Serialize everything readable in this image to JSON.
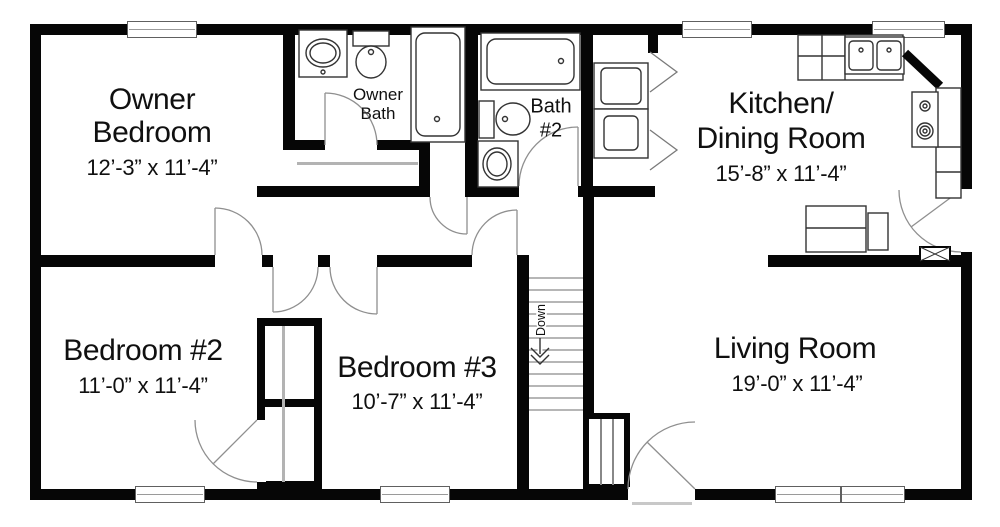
{
  "rooms": {
    "owner_bedroom": {
      "line1": "Owner",
      "line2": "Bedroom",
      "dims": "12’-3” x 11’-4”"
    },
    "owner_bath": {
      "line1": "Owner",
      "line2": "Bath"
    },
    "bath_2": {
      "line1": "Bath",
      "line2": "#2"
    },
    "kitchen_dining": {
      "line1": "Kitchen/",
      "line2": "Dining Room",
      "dims": "15’-8” x 11’-4”"
    },
    "bedroom_2": {
      "name": "Bedroom #2",
      "dims": "11’-0” x 11’-4”"
    },
    "bedroom_3": {
      "name": "Bedroom #3",
      "dims": "10’-7” x 11’-4”"
    },
    "living_room": {
      "name": "Living Room",
      "dims": "19’-0” x 11’-4”"
    },
    "stairs": {
      "label": "Down"
    }
  },
  "colors": {
    "wall": "#060606",
    "fixture_stroke": "#333333",
    "door_arc": "#8f8f8f",
    "sliding_door": "#b3b3b3",
    "stair_tread": "#8a8a8a",
    "window_frame": "#606060",
    "text": "#101010",
    "background": "#ffffff"
  }
}
